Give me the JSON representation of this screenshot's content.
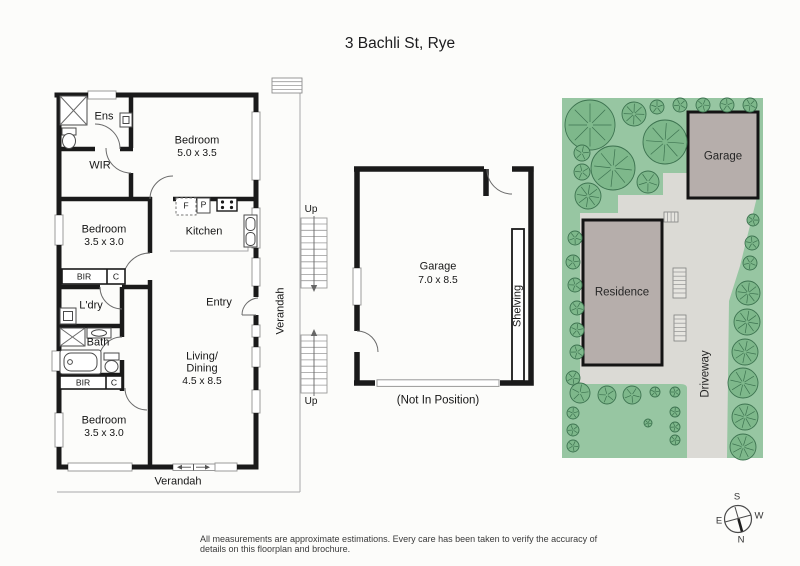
{
  "title": "3 Bachli St, Rye",
  "footer": "All measurements are approximate estimations. Every care has been taken to verify the accuracy of details on this floorplan and brochure.",
  "floorplan": {
    "ens": "Ens",
    "wir": "WIR",
    "bedroom1": {
      "name": "Bedroom",
      "dims": "5.0 x 3.5"
    },
    "bedroom2": {
      "name": "Bedroom",
      "dims": "3.5 x 3.0"
    },
    "bedroom3": {
      "name": "Bedroom",
      "dims": "3.5 x 3.0"
    },
    "kitchen": "Kitchen",
    "fridge": "F",
    "pantry": "P",
    "bir": "BIR",
    "cupboard": "C",
    "laundry": "L'dry",
    "bath": "Bath",
    "entry": "Entry",
    "living": {
      "line1": "Living/",
      "line2": "Dining",
      "dims": "4.5 x 8.5"
    },
    "verandah": "Verandah",
    "up": "Up"
  },
  "garage_plan": {
    "name": "Garage",
    "dims": "7.0 x 8.5",
    "shelving": "Shelving",
    "note": "(Not In Position)"
  },
  "site_plan": {
    "garage": "Garage",
    "residence": "Residence",
    "driveway": "Driveway",
    "colors": {
      "grass": "#97c6a2",
      "tree_fill": "#7eb88b",
      "tree_stroke": "#3d7350",
      "building": "#b6aeab",
      "building_border": "#141414",
      "paving": "#dbdad5"
    },
    "trees": [
      [
        590,
        125,
        25
      ],
      [
        634,
        114,
        12
      ],
      [
        665,
        142,
        22
      ],
      [
        613,
        168,
        22
      ],
      [
        588,
        196,
        13
      ],
      [
        648,
        182,
        11
      ],
      [
        582,
        153,
        8
      ],
      [
        582,
        172,
        8
      ],
      [
        575,
        238,
        7
      ],
      [
        573,
        262,
        7
      ],
      [
        575,
        285,
        7
      ],
      [
        577,
        308,
        7
      ],
      [
        577,
        330,
        7
      ],
      [
        577,
        352,
        7
      ],
      [
        573,
        378,
        7
      ],
      [
        573,
        413,
        6
      ],
      [
        573,
        430,
        6
      ],
      [
        573,
        446,
        6
      ],
      [
        657,
        107,
        7
      ],
      [
        680,
        105,
        7
      ],
      [
        703,
        105,
        7
      ],
      [
        727,
        105,
        7
      ],
      [
        750,
        105,
        7
      ],
      [
        753,
        220,
        6
      ],
      [
        752,
        243,
        7
      ],
      [
        750,
        263,
        7
      ],
      [
        748,
        293,
        12
      ],
      [
        747,
        322,
        13
      ],
      [
        745,
        352,
        13
      ],
      [
        743,
        383,
        15
      ],
      [
        745,
        417,
        13
      ],
      [
        743,
        447,
        13
      ],
      [
        580,
        393,
        10
      ],
      [
        607,
        395,
        9
      ],
      [
        632,
        395,
        9
      ],
      [
        655,
        392,
        5
      ],
      [
        675,
        392,
        5
      ],
      [
        648,
        423,
        4
      ],
      [
        675,
        412,
        5
      ],
      [
        675,
        427,
        5
      ],
      [
        675,
        440,
        5
      ]
    ]
  },
  "compass": {
    "north": "N",
    "south": "S",
    "east": "E",
    "west": "W"
  }
}
